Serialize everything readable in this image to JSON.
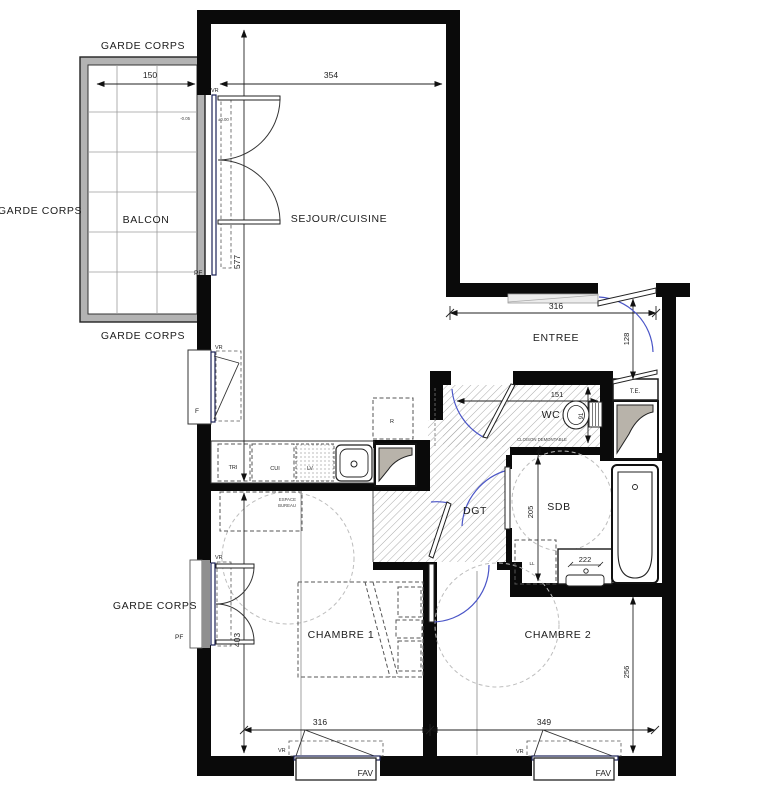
{
  "plan": {
    "rooms": {
      "balcon": "BALCON",
      "sejour": "SEJOUR/CUISINE",
      "entree": "ENTREE",
      "wc": "WC",
      "sdb": "SDB",
      "dgt": "DGT",
      "chambre1": "CHAMBRE 1",
      "chambre2": "CHAMBRE 2"
    },
    "dims": {
      "balcon_w": "150",
      "sejour_w": "354",
      "sejour_h": "577",
      "entree_w": "316",
      "entree_door": "128",
      "wc_w": "151",
      "wc_d": "91",
      "sdb_h": "205",
      "vasque": "222",
      "ch1_h": "403",
      "ch1_w": "316",
      "ch2_w": "349",
      "ch2_h": "256"
    },
    "labels": {
      "garde_corps": "GARDE CORPS",
      "pf": "PF",
      "f": "F",
      "vr": "VR",
      "fav": "FAV",
      "te": "T.E.",
      "tri": "TRI",
      "cui": "CUI",
      "lv": "LV",
      "r": "R",
      "ll": "LL",
      "cloison": "CLOISON DEMONTABLE",
      "espace1": "ESPACE",
      "espace2": "BUREAU",
      "level_in": "±0.00",
      "level_out": "-0.05"
    },
    "colors": {
      "wall": "#0a0a0a",
      "door_arc": "#4a55c7",
      "glazing": "#1c2257",
      "hatch": "#9a9a9a",
      "shaft": "#b8b3aa"
    }
  }
}
